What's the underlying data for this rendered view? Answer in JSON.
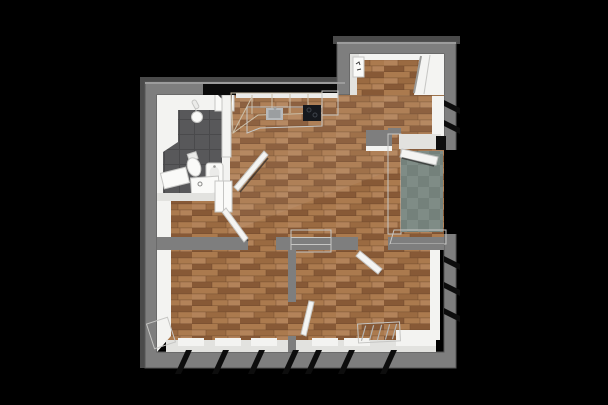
{
  "scene": {
    "kind": "3d-floorplan-render",
    "background": "#000000"
  },
  "colors": {
    "background": "#000000",
    "wall": "#7e7e7e",
    "wall_dark": "#4a4a4a",
    "wall_cap_light": "#9c9c9c",
    "inner_white": "#f3f3f1",
    "inner_shade": "#e2e2df",
    "door_white": "#f4f4f2",
    "door_edge": "#9a9a98",
    "kitchen_shadow": "#0b0b0b",
    "window_void": "#0d0d0d",
    "wood_a": "#ab7a4e",
    "wood_b": "#9a6a41",
    "wood_c": "#875936",
    "wood_d": "#b3835a",
    "wood_seam": "#6d482c",
    "bath_tile": "#58585a",
    "bath_grout": "#4a4a4c",
    "bath_niche_dark": "#3c3c3e",
    "balcony_tile": "#7f8c86",
    "balcony_tile_dark": "#74817b",
    "cabinet_beige": "#e7ddcc",
    "cabinet_edge": "#cdc0a9",
    "counter": "#ececea",
    "cooktop": "#15181d",
    "cooktop_edge": "#3e434b",
    "steel": "#b7babc",
    "steel_dark": "#9b9ea0",
    "fixture_white": "#fafaf8",
    "fixture_soft": "#ebebe9",
    "panel_mark": "#3a3a3a"
  },
  "rooms": [
    {
      "id": "entry-nook",
      "floor": "wood"
    },
    {
      "id": "kitchen",
      "floor": "wood"
    },
    {
      "id": "living-area",
      "floor": "wood"
    },
    {
      "id": "bathroom",
      "floor": "dark-tile"
    },
    {
      "id": "hallway",
      "floor": "wood"
    },
    {
      "id": "room-bottom-left",
      "floor": "wood"
    },
    {
      "id": "room-bottom-right",
      "floor": "wood"
    },
    {
      "id": "balcony",
      "floor": "green-tile"
    }
  ],
  "fixtures": [
    "kitchen-upper-cabinets",
    "kitchen-counter",
    "kitchen-sink",
    "cooktop",
    "tall-kitchen-unit",
    "shower-head",
    "shower-niche",
    "toilet",
    "wall-sink",
    "vanity-cabinet",
    "washer-cabinet",
    "tall-cabinet",
    "sideboard",
    "radiator",
    "electrical-panel",
    "entrance-door",
    "balcony-door",
    "bathroom-door",
    "room-left-door",
    "room-right-door",
    "connecting-door"
  ],
  "windows": {
    "bottom_wall_slits": 7,
    "right_wall_upper_slits": 2,
    "right_wall_lower_slits": 3
  }
}
